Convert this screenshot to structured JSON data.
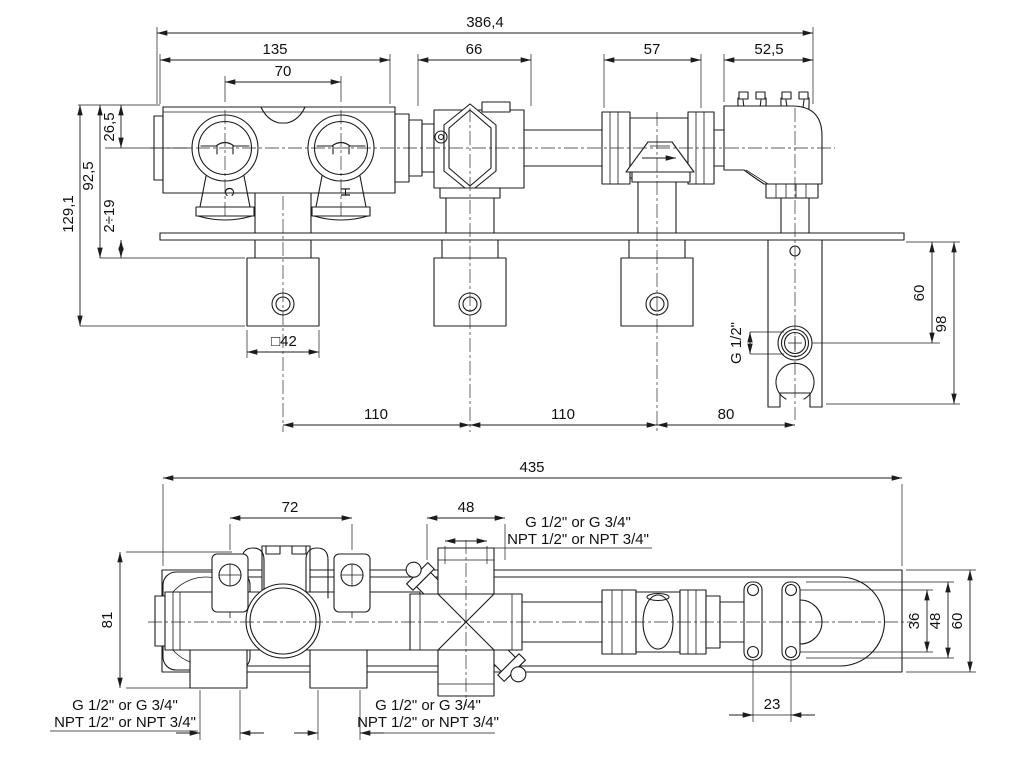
{
  "front_view": {
    "overall_width": "386,4",
    "body_width": "135",
    "handle_centers": "70",
    "diverter_width": "66",
    "check_valve_width": "57",
    "elbow_width": "52,5",
    "top_to_center": "26,5",
    "top_to_plate": "92,5",
    "total_depth": "129,1",
    "wall_thickness_range": "2÷19",
    "escutcheon_size": "□42",
    "center_spacing_1": "110",
    "center_spacing_2": "110",
    "center_spacing_3": "80",
    "outlet_thread": "G 1/2\"",
    "outlet_offset": "60",
    "bracket_length": "98",
    "cold_marker": "C",
    "hot_marker": "H"
  },
  "plan_view": {
    "overall_length": "435",
    "clip_spacing": "72",
    "cross_width": "48",
    "body_depth": "81",
    "screw_spacing_vertical": "36",
    "bracket_plate_width": "48",
    "plate_depth": "60",
    "screw_spacing_horizontal": "23",
    "thread_option_g": "G 1/2\" or G 3/4\"",
    "thread_option_npt": "NPT 1/2\" or NPT 3/4\""
  }
}
